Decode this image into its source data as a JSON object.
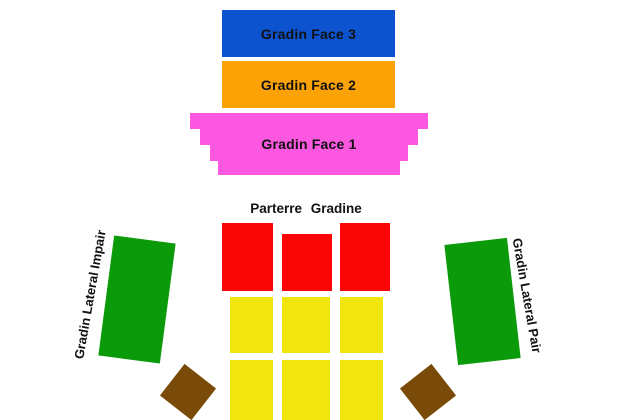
{
  "map": {
    "background": "#ffffff",
    "text_color": "#111111",
    "sections": {
      "gradin_face_3": {
        "label": "Gradin Face 3",
        "color": "#0d53cf"
      },
      "gradin_face_2": {
        "label": "Gradin Face 2",
        "color": "#fba306"
      },
      "gradin_face_1": {
        "label": "Gradin Face 1",
        "color": "#fb57e0"
      },
      "parterre_gradine": {
        "label": "Parterre Gradine"
      },
      "parterre_front": {
        "color": "#fb0606",
        "block_count": 3
      },
      "parterre_rear": {
        "color": "#f0e60d",
        "block_count": 6
      },
      "gradin_lateral_impair": {
        "label": "Gradin Lateral Impair",
        "color": "#0a9a0a"
      },
      "gradin_lateral_pair": {
        "label": "Gradin Lateral Pair",
        "color": "#0a9a0a"
      },
      "corner_blocks": {
        "color": "#7a4a08",
        "block_count": 2
      }
    }
  }
}
